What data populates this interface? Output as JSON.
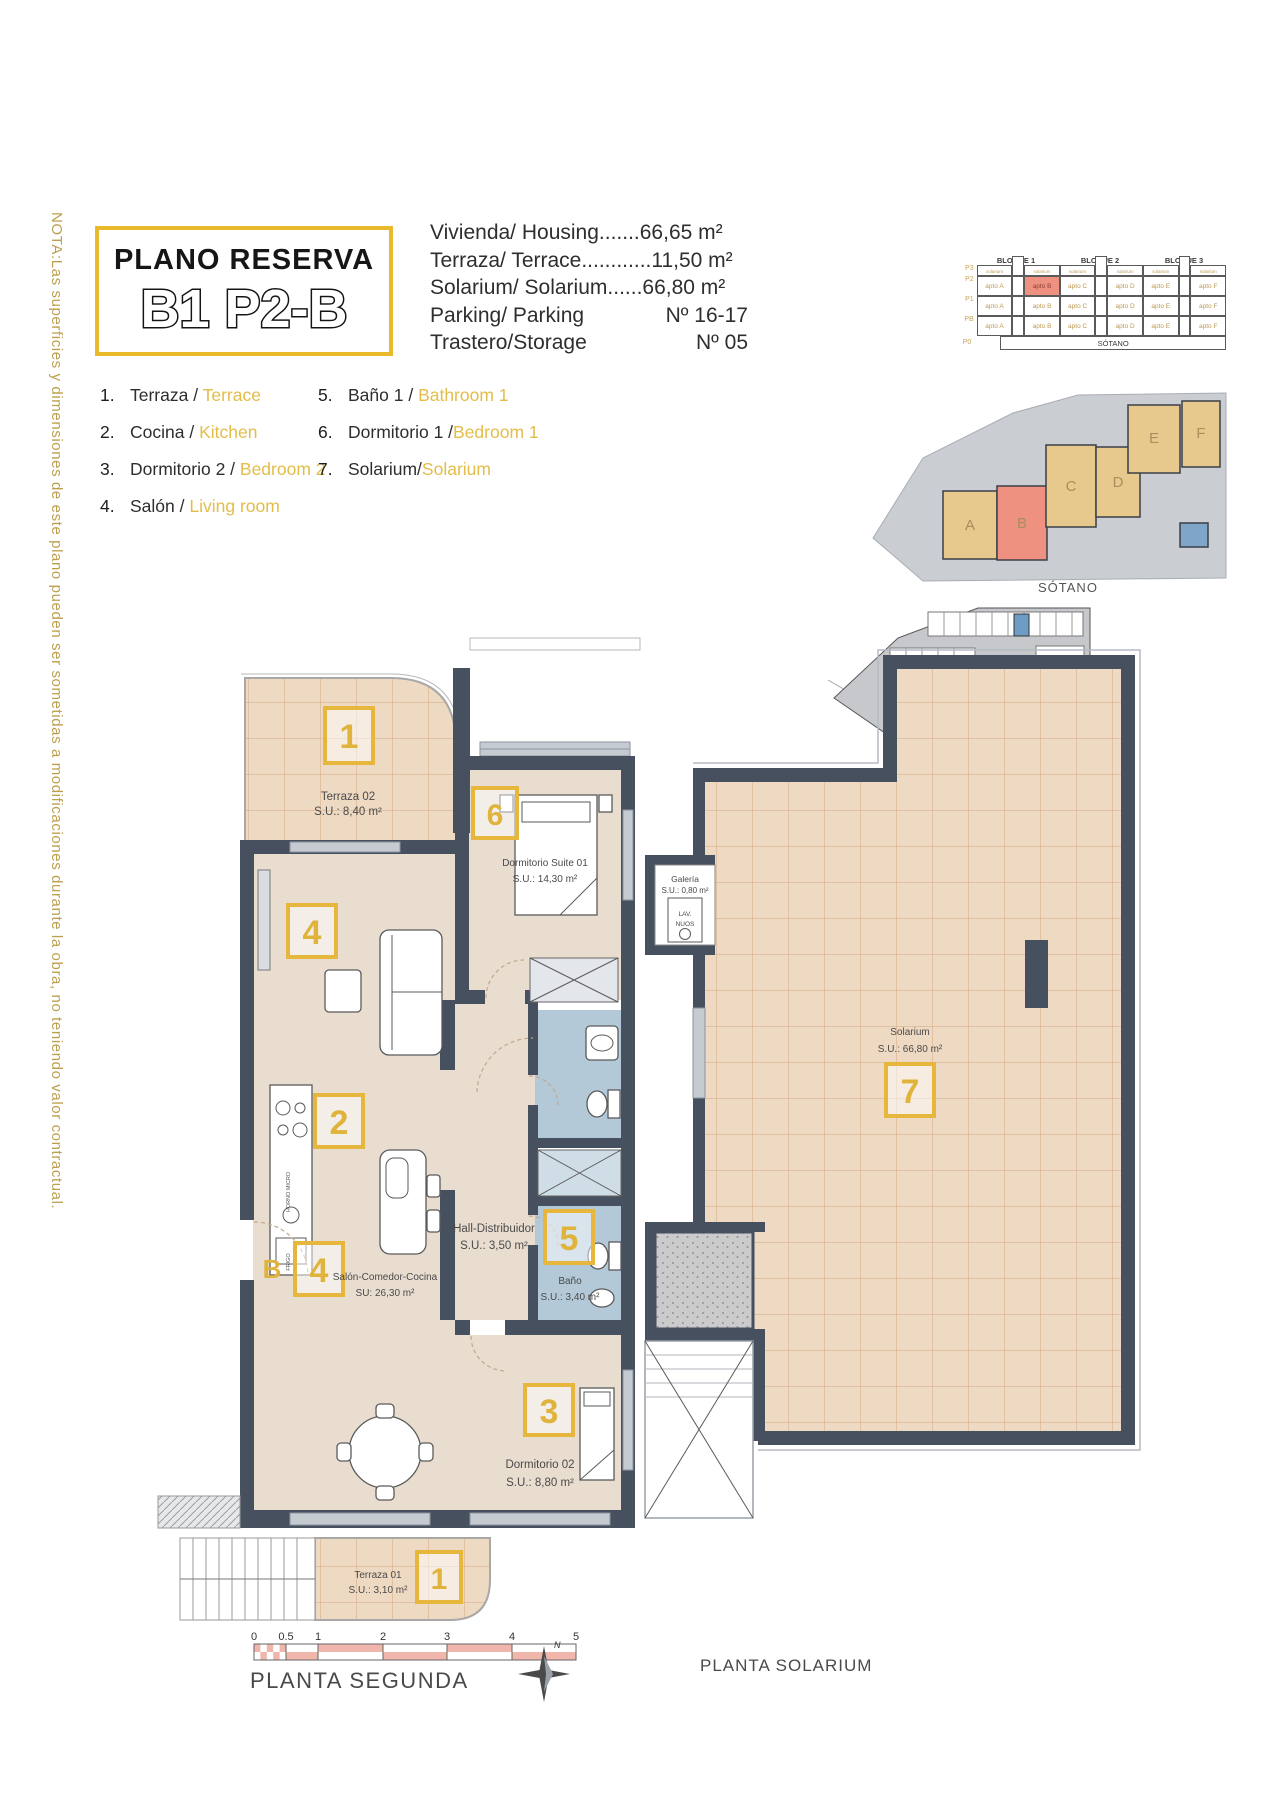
{
  "note": "NOTA:Las superficies y dimensiones de este plano pueden ser sometidas a modificaciones durante la obra, no teniendo valor contractual.",
  "title": {
    "line1": "PLANO RESERVA",
    "line2": "B1 P2-B"
  },
  "specs": [
    {
      "label": "Vivienda/ Housing",
      "dots": ".......",
      "value": "66,65 m²"
    },
    {
      "label": "Terraza/ Terrace",
      "dots": "............",
      "value": "11,50 m²"
    },
    {
      "label": "Solarium/ Solarium",
      "dots": "......",
      "value": "66,80 m²"
    },
    {
      "label": "Parking/ Parking",
      "dots": "",
      "value": "Nº 16-17"
    },
    {
      "label": "Trastero/Storage",
      "dots": "",
      "value": "Nº 05"
    }
  ],
  "blocks": {
    "titles": [
      "BLOQUE 1",
      "BLOQUE 2",
      "BLOQUE 3"
    ],
    "floors": [
      "P3",
      "P2",
      "P1",
      "PB",
      "P0"
    ],
    "solarium_cell": "solarium",
    "apts": [
      "apto A",
      "apto B",
      "apto C",
      "apto D",
      "apto E",
      "apto F"
    ],
    "basement": "SÓTANO",
    "sotano_title": "SÓTANO",
    "site_letters": [
      "A",
      "B",
      "C",
      "D",
      "E",
      "F"
    ]
  },
  "legend": {
    "items": [
      {
        "num": "1.",
        "es": "Terraza / ",
        "en": "Terrace"
      },
      {
        "num": "2.",
        "es": "Cocina / ",
        "en": "Kitchen"
      },
      {
        "num": "3.",
        "es": "Dormitorio 2 / ",
        "en": "Bedroom 2"
      },
      {
        "num": "4.",
        "es": "Salón / ",
        "en": "Living room"
      },
      {
        "num": "5.",
        "es": "Baño 1 / ",
        "en": "Bathroom 1"
      },
      {
        "num": "6.",
        "es": "Dormitorio 1 /",
        "en": "Bedroom 1"
      },
      {
        "num": "7.",
        "es": "Solarium/",
        "en": "Solarium"
      }
    ]
  },
  "plan": {
    "terraza02": {
      "name": "Terraza 02",
      "area": "S.U.: 8,40 m²",
      "badge": "1"
    },
    "suite": {
      "name": "Dormitorio Suite 01",
      "area": "S.U.: 14,30 m²",
      "badge": "6"
    },
    "salon": {
      "name": "Salón-Comedor-Cocina",
      "area": "SU: 26,30 m²",
      "badge_top": "4",
      "badge_bottom": "4"
    },
    "cocina": {
      "badge": "2",
      "fridge": "FRIGO",
      "oven": "HORNO MICRO"
    },
    "hall": {
      "name": "Hall-Distribuidor",
      "area": "S.U.: 3,50 m²"
    },
    "bano": {
      "name": "Baño",
      "area": "S.U.: 3,40 m²",
      "badge": "5"
    },
    "dorm02": {
      "name": "Dormitorio 02",
      "area": "S.U.: 8,80 m²",
      "badge": "3"
    },
    "terraza01": {
      "name": "Terraza 01",
      "area": "S.U.: 3,10 m²",
      "badge": "1"
    },
    "entrance": "B"
  },
  "solarium": {
    "name": "Solarium",
    "area": "S.U.: 66,80 m²",
    "badge": "7",
    "galeria": {
      "name": "Galería",
      "area": "S.U.: 0,80 m²",
      "lav1": "LAV.",
      "lav2": "NUOS"
    }
  },
  "footer": {
    "scale_ticks": [
      "0",
      "0.5",
      "1",
      "2",
      "3",
      "4",
      "5"
    ],
    "caption_left": "PLANTA SEGUNDA",
    "caption_right": "PLANTA SOLARIUM",
    "compass": "N"
  },
  "colors": {
    "accent": "#E8BD3A",
    "wall": "#47505E",
    "floor": "#E9DDD0",
    "tile": "#EED9C3",
    "bath": "#B3C9D8",
    "highlight": "#EF9181",
    "scale_pink": "#F0B5AB"
  }
}
